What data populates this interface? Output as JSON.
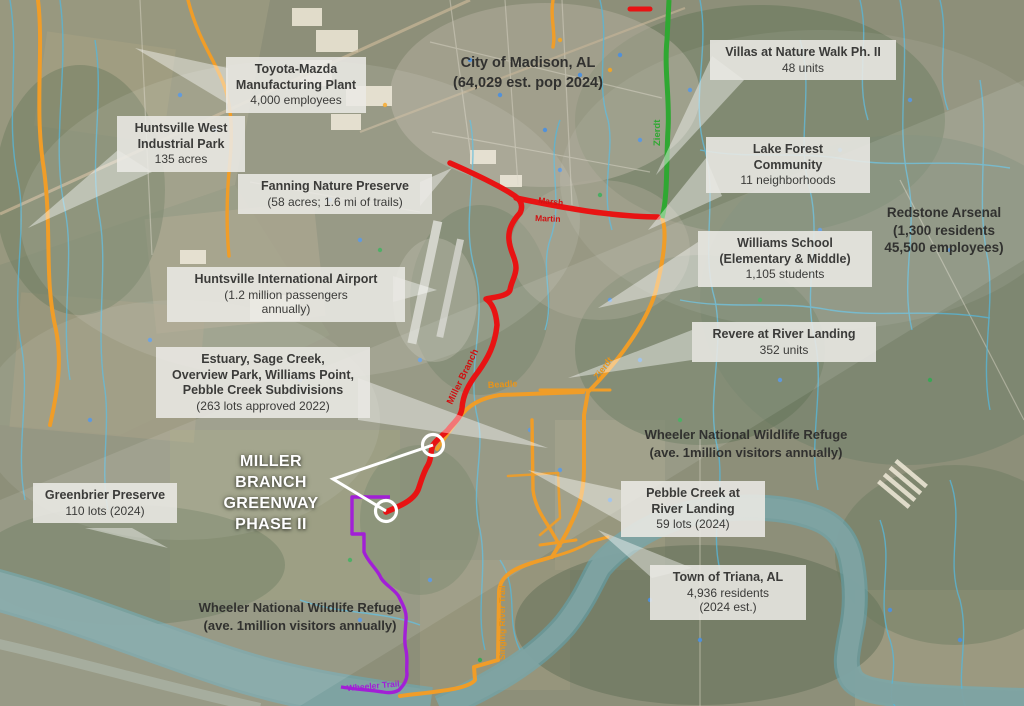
{
  "callouts": {
    "toyota": {
      "l1": "Toyota-Mazda",
      "l2": "Manufacturing Plant",
      "l3": "4,000 employees"
    },
    "huntsville_west": {
      "l1": "Huntsville West",
      "l2": "Industrial Park",
      "l3": "135 acres"
    },
    "fanning": {
      "l1": "Fanning Nature Preserve",
      "l2": "(58 acres; 1.6 mi of trails)"
    },
    "villas": {
      "l1": "Villas at Nature Walk Ph. II",
      "l2": "48 units"
    },
    "lake_forest": {
      "l1": "Lake Forest",
      "l2": "Community",
      "l3": "11 neighborhoods"
    },
    "williams_school": {
      "l1": "Williams School",
      "l2": "(Elementary & Middle)",
      "l3": "1,105 students"
    },
    "revere": {
      "l1": "Revere at River Landing",
      "l2": "352 units"
    },
    "estuary": {
      "l1": "Estuary, Sage Creek,",
      "l2": "Overview Park, Williams Point,",
      "l3": "Pebble Creek Subdivisions",
      "l4": "(263 lots approved 2022)"
    },
    "airport": {
      "l1": "Huntsville International Airport",
      "l2": "(1.2 million passengers",
      "l3": "annually)"
    },
    "greenbrier": {
      "l1": "Greenbrier Preserve",
      "l2": "110 lots (2024)"
    },
    "pebble_creek": {
      "l1": "Pebble Creek at",
      "l2": "River Landing",
      "l3": "59 lots (2024)"
    },
    "triana": {
      "l1": "Town of Triana, AL",
      "l2": "4,936 residents",
      "l3": "(2024 est.)"
    }
  },
  "plain_labels": {
    "madison": {
      "l1": "City of Madison, AL",
      "l2": "(64,029 est. pop 2024)"
    },
    "redstone": {
      "l1": "Redstone Arsenal",
      "l2": "(1,300 residents",
      "l3": "45,500 employees)"
    },
    "wheeler_right": {
      "l1": "Wheeler National Wildlife Refuge",
      "l2": "(ave. 1million visitors annually)"
    },
    "wheeler_bottom": {
      "l1": "Wheeler National Wildlife Refuge",
      "l2": "(ave. 1million visitors annually)"
    },
    "project_title": {
      "l1": "MILLER BRANCH",
      "l2": "GREENWAY",
      "l3": "PHASE II"
    }
  },
  "route_labels": {
    "zierdt_green": "Zierdt",
    "zierdt_orange": "Zierdt",
    "beadle": "Beadle",
    "marsh": "Marsh",
    "martin": "Martin",
    "miller_branch": "Miller Branch",
    "wheeler_trail": "Wheeler Trail",
    "singing_river_trail": "Singing River Trail"
  },
  "colors": {
    "greenway_red": "#e81313",
    "trail_purple": "#a21fd6",
    "road_orange": "#f09d28",
    "road_green": "#2fa832",
    "creek_blue": "#58b6d8",
    "river_teal": "#7fa3a2"
  }
}
